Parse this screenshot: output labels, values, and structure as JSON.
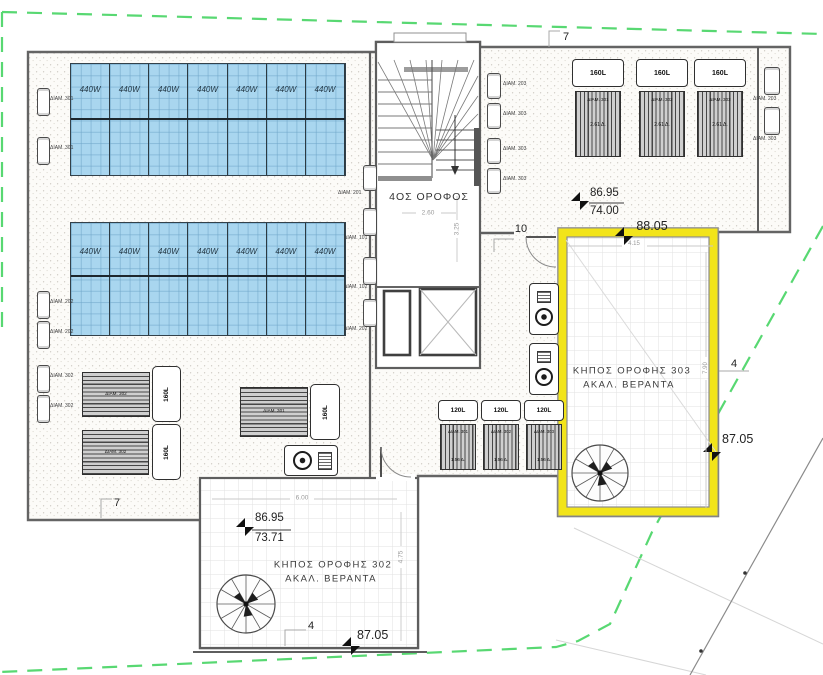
{
  "floor_label": "4ΟΣ ΟΡΟΦΟΣ",
  "gardens": {
    "g303_line1": "ΚΗΠΟΣ ΟΡΟΦΗΣ 303",
    "g303_line2": "ΑΚΑΛ. ΒΕΡΑΝΤΑ",
    "g302_line1": "ΚΗΠΟΣ ΟΡΟΦΗΣ 302",
    "g302_line2": "ΑΚΑΛ. ΒΕΡΑΝΤΑ"
  },
  "elevations": {
    "ne_top": "86.95",
    "ne_bottom": "74.00",
    "ne_level": "88.05",
    "east_level": "87.05",
    "sw_top": "86.95",
    "sw_bottom": "73.71",
    "south_level": "87.05"
  },
  "dimensions": {
    "top_width": "7",
    "left_width": "7",
    "door": "10",
    "right_depth": "4",
    "bottom_depth": "4",
    "stair_w": "2.60",
    "stair_d": "3.25",
    "g302_w": "6.00",
    "g302_d": "4.75",
    "g303_w": "4.15",
    "g303_d": "7.90"
  },
  "solar": {
    "array1": [
      "440W",
      "440W",
      "440W",
      "440W",
      "440W",
      "440W",
      "440W"
    ],
    "array2": [
      "440W",
      "440W",
      "440W",
      "440W",
      "440W",
      "440W",
      "440W"
    ]
  },
  "b160top": [
    {
      "tank": "160L",
      "unit": "ΔΙΑΜ. 301",
      "area": "2.61 Δ."
    },
    {
      "tank": "160L",
      "unit": "ΔΙΑΜ. 302",
      "area": "2.61 Δ."
    },
    {
      "tank": "160L",
      "unit": "ΔΙΑΜ. 303",
      "area": "2.61 Δ."
    }
  ],
  "b160side": [
    {
      "tank": "160L",
      "unit": "ΔΙΑΜ. 302"
    },
    {
      "tank": "160L",
      "unit": "ΔΙΑΜ. 302"
    },
    {
      "tank": "160L",
      "unit": "ΔΙΑΜ. 301"
    }
  ],
  "b120": [
    {
      "tank": "120L",
      "unit": "ΔΙΑΜ. 301",
      "area": "1.56 Δ."
    },
    {
      "tank": "120L",
      "unit": "ΔΙΑΜ. 302",
      "area": "1.56 Δ."
    },
    {
      "tank": "120L",
      "unit": "ΔΙΑΜ. 303",
      "area": "1.56 Δ."
    }
  ],
  "ac": {
    "left": [
      "ΔΙΑΜ. 301",
      "ΔΙΑΜ. 301",
      "ΔΙΑΜ. 202",
      "ΔΙΑΜ. 202",
      "ΔΙΑΜ. 302",
      "ΔΙΑΜ. 302"
    ],
    "inner": [
      "ΔΙΑΜ. 201",
      "ΔΙΑΜ. 101",
      "ΔΙΑΜ. 102",
      "ΔΙΑΜ. 202"
    ],
    "stair": [
      "ΔΙΑΜ. 203",
      "ΔΙΑΜ. 303",
      "ΔΙΑΜ. 303",
      "ΔΙΑΜ. 303"
    ],
    "right": [
      "ΔΙΑΜ. 203",
      "ΔΙΑΜ. 303"
    ]
  },
  "colors": {
    "panel_blue": "#a9d6ef",
    "highlight_yellow": "#f2e41a",
    "boundary_green": "#46d463",
    "wall_gray": "#646464"
  }
}
